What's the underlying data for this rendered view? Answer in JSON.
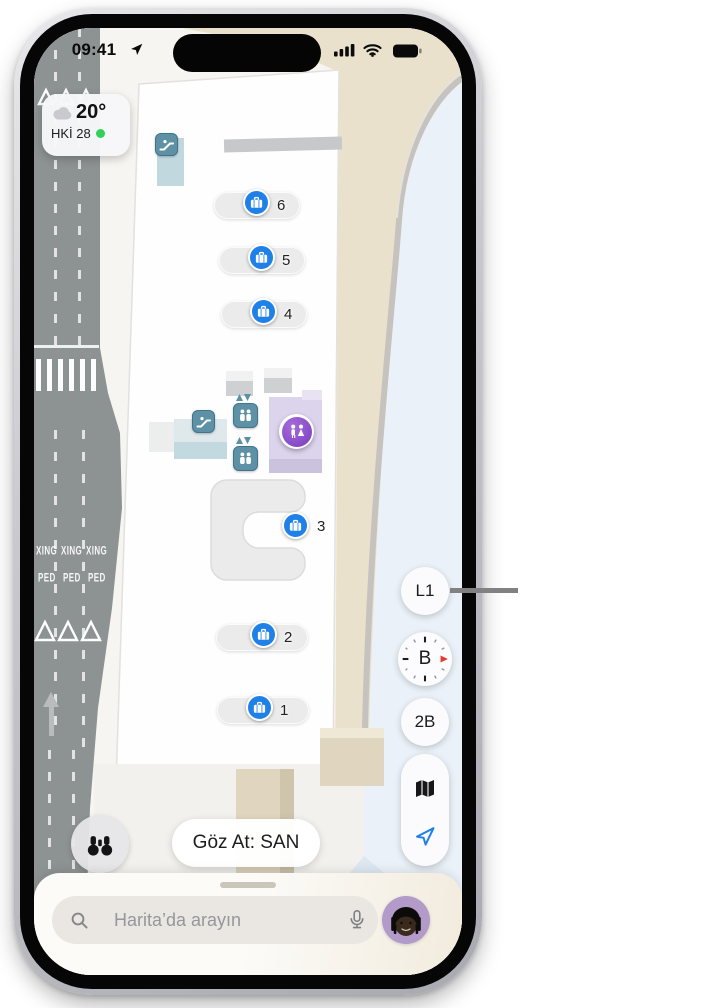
{
  "colors": {
    "accent_blue": "#1f80e8",
    "transit_teal": "#5e90a6",
    "restroom_purple": "#7b3cc0",
    "air_quality_green": "#30d158",
    "road_gray": "#8d9292",
    "terminal_beige": "#e9e1cc"
  },
  "status_bar": {
    "time": "09:41",
    "location_icon": "navigation-arrow",
    "signal_icon": "cellular-signal",
    "wifi_icon": "wifi",
    "battery_icon": "battery-full"
  },
  "weather_widget": {
    "temperature": "20°",
    "air_quality_label": "HKİ 28",
    "condition_icon": "cloud"
  },
  "map": {
    "road_markings": {
      "crossing_text": "XING",
      "pedestrian_text": "PED"
    },
    "poi": {
      "baggage_claims": [
        {
          "label": "6"
        },
        {
          "label": "5"
        },
        {
          "label": "4"
        },
        {
          "label": "3"
        },
        {
          "label": "2"
        },
        {
          "label": "1"
        }
      ],
      "baggage_icon": "suitcase",
      "escalator_icon": "escalator",
      "elevator_icon": "elevator",
      "restroom_icon": "restroom"
    }
  },
  "map_controls": {
    "floor_level": "L1",
    "compass_direction": "B",
    "view_mode": "2B",
    "map_mode_icon": "folded-map",
    "locate_icon": "location-arrow",
    "look_around_icon": "binoculars"
  },
  "browse_bar": {
    "label": "Göz At: SAN"
  },
  "search_bar": {
    "placeholder": "Harita’da arayın",
    "search_icon": "magnifier",
    "mic_icon": "microphone",
    "avatar": "memoji-avatar"
  }
}
